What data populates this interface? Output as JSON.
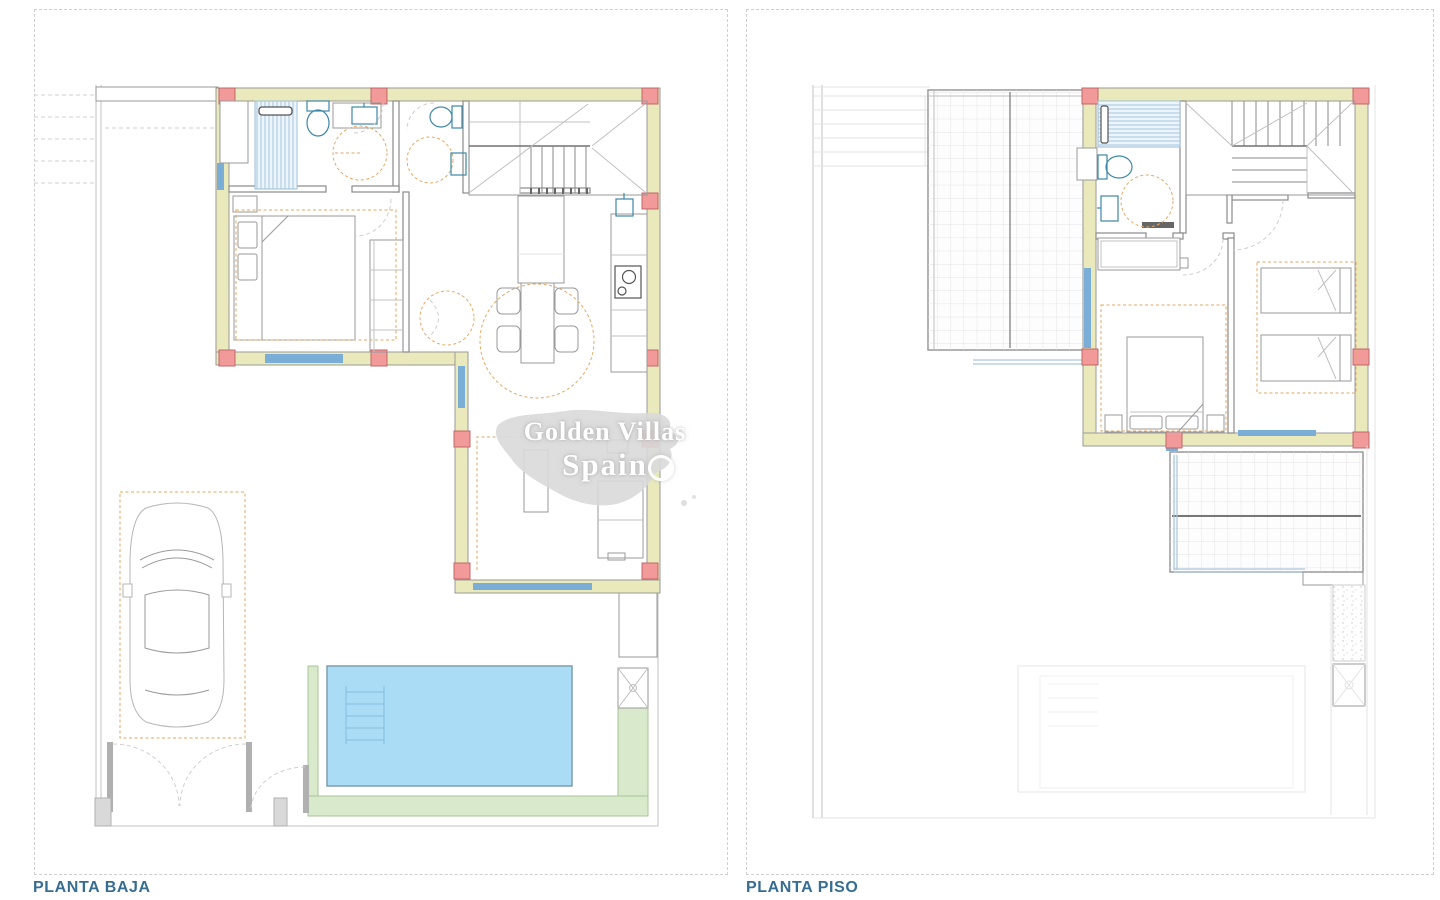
{
  "sheets": [
    {
      "label": "PLANTA BAJA"
    },
    {
      "label": "PLANTA PISO"
    }
  ],
  "watermark": {
    "line1": "Golden Villas",
    "line2": "Spain"
  },
  "palette": {
    "label_color": "#366d92",
    "sheet_border": "#cfcfcf",
    "wall_fill": "#e9e9bc",
    "wall_edge": "#9a9a9a",
    "column_fill": "#f29a9a",
    "column_edge": "#c06868",
    "window_blue": "#7aaed6",
    "fixture_blue": "#3d87a8",
    "furniture_gray": "#9a9a9a",
    "light_gray": "#c0c0c0",
    "faint_gray": "#e3e3e3",
    "dark_line": "#707070",
    "dash_orange": "#e2aa66",
    "pool_fill": "#abdcf6",
    "pool_edge": "#7d9eae",
    "green_fill": "#d9e9cc",
    "green_edge": "#a9c49a",
    "watermark_gray": "#d9d9d9"
  }
}
